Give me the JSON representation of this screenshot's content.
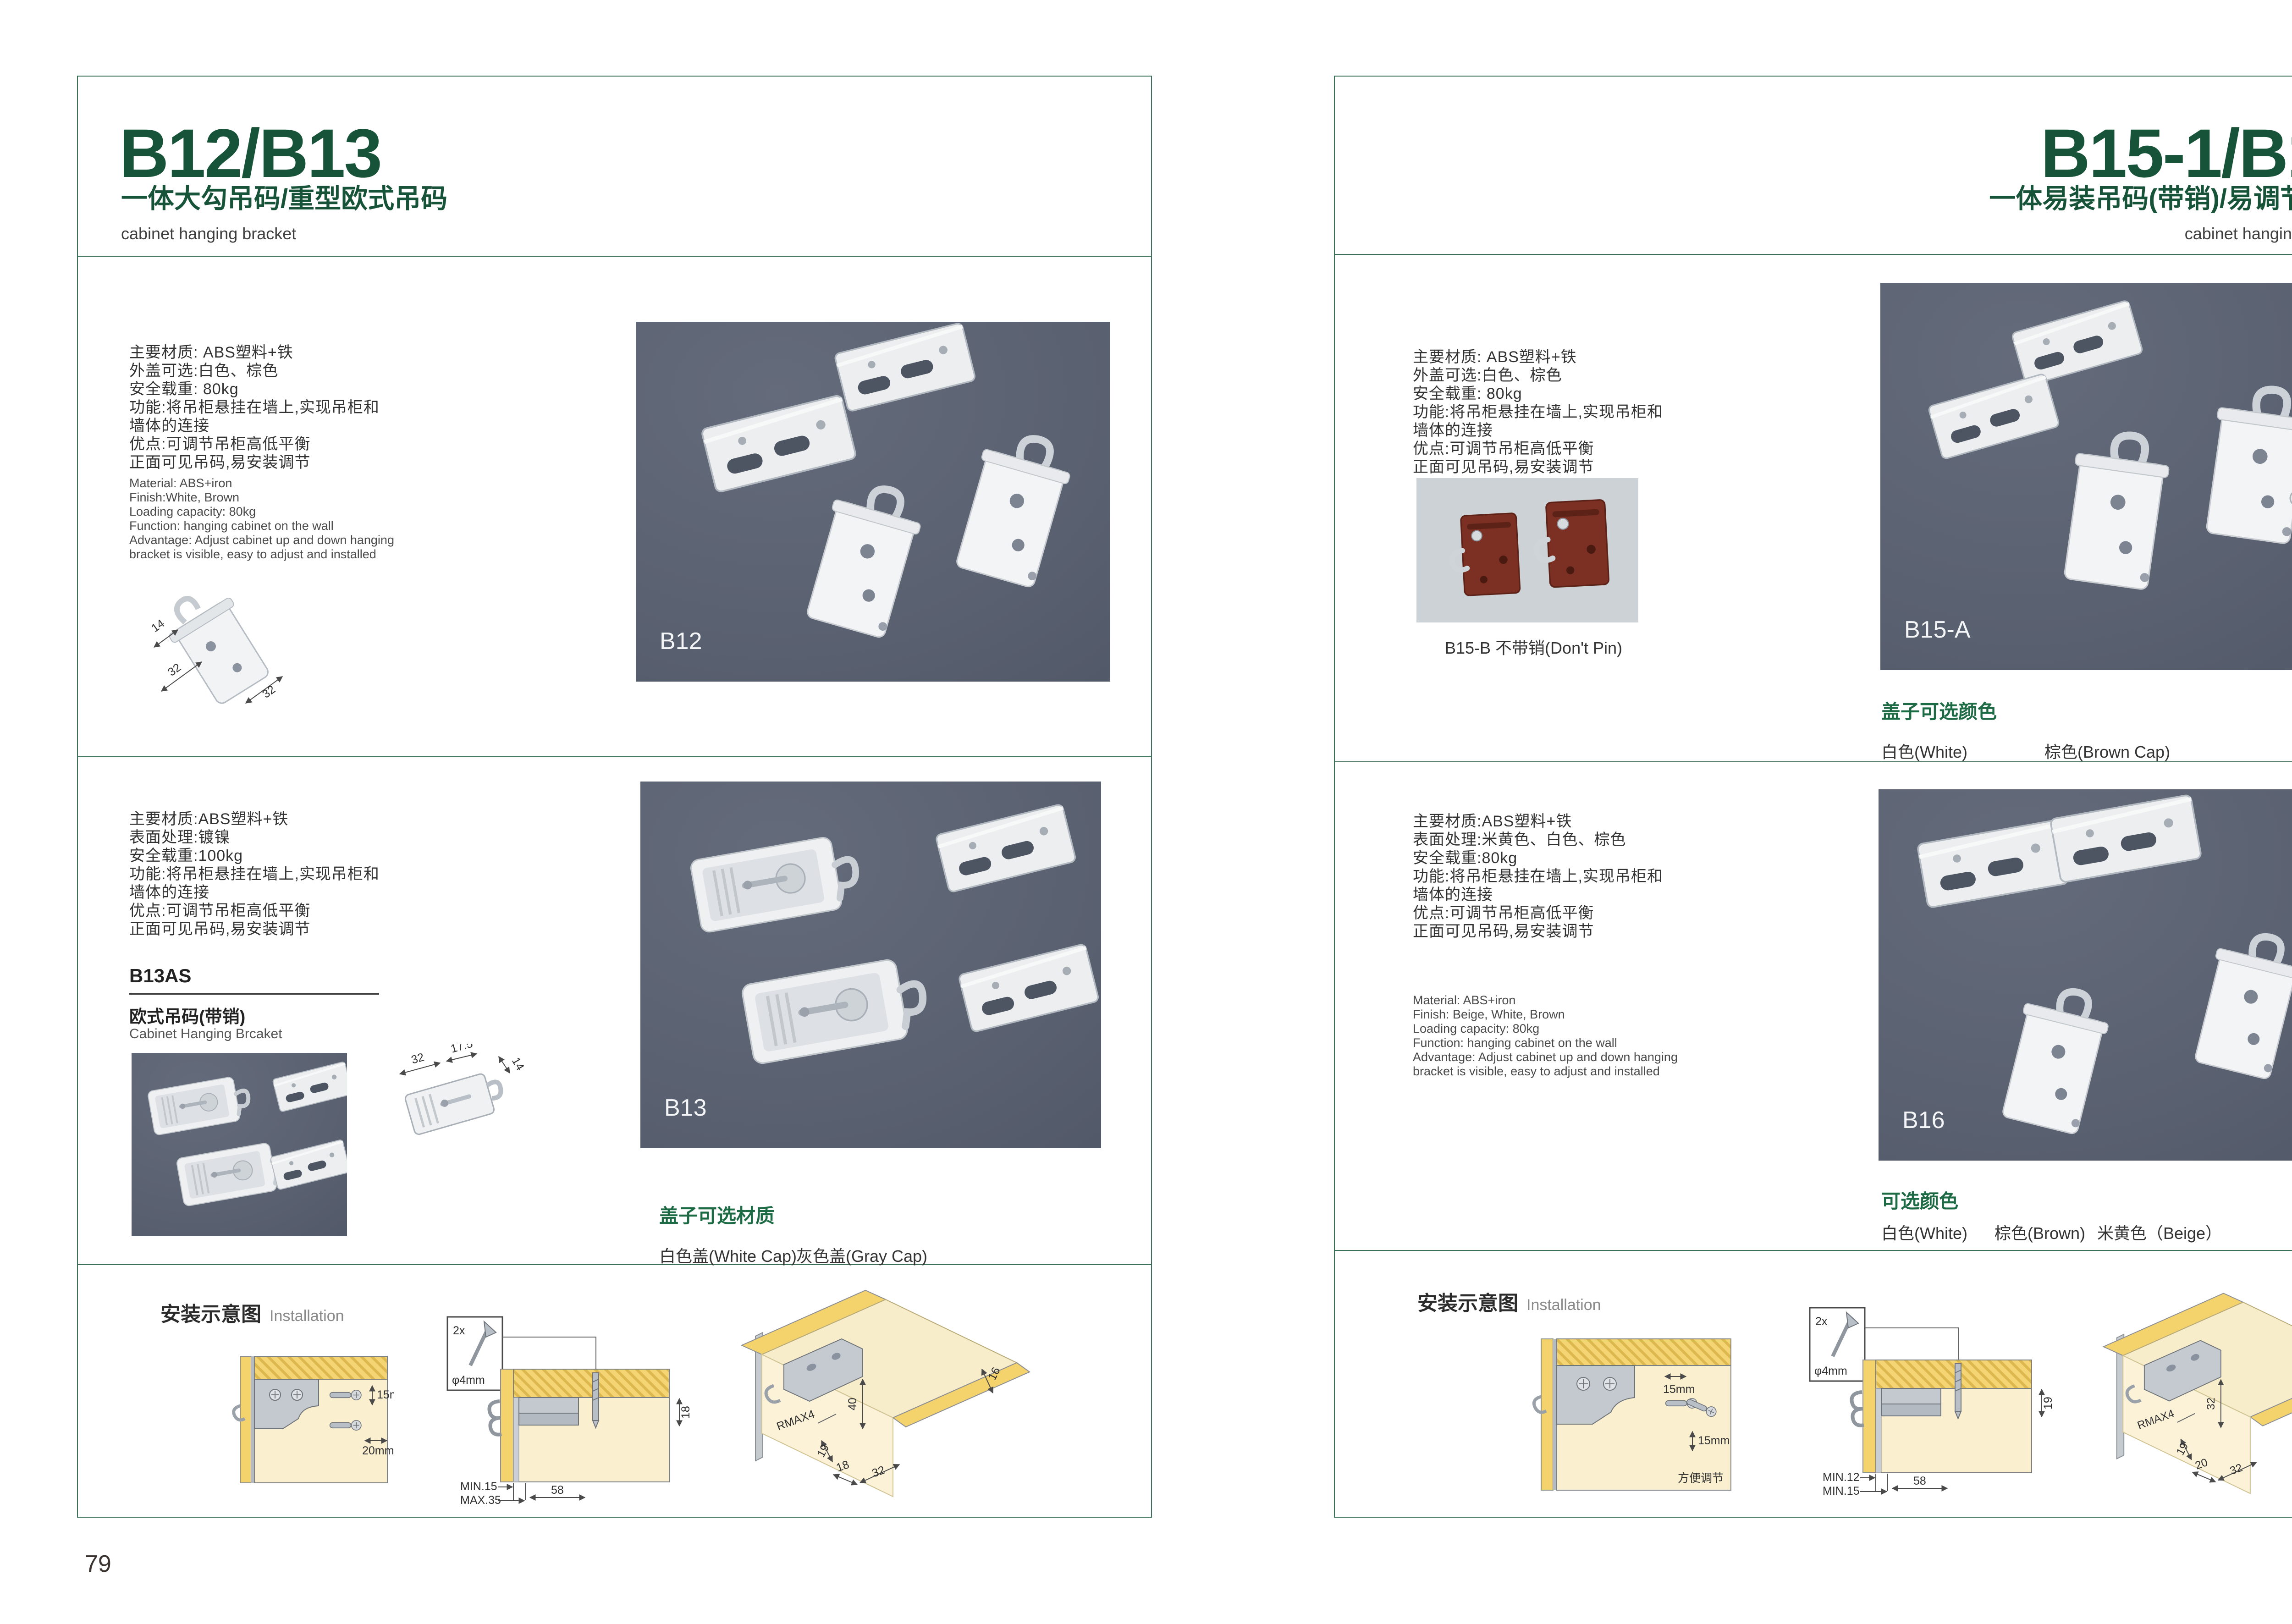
{
  "colors": {
    "accent_green": "#175339",
    "frame_green": "#3a6f58",
    "photo_dark_bg": "#596070",
    "photo_light_bg": "#cdd2d6",
    "wood_yellow": "#f4d36c",
    "wood_face": "#faf0d0"
  },
  "left": {
    "title": "B12/B13",
    "subtitle": "一体大勾吊码/重型欧式吊码",
    "category_en": "cabinet hanging bracket",
    "page_no": "79",
    "s1": {
      "cn": [
        "主要材质: ABS塑料+铁",
        "外盖可选:白色、棕色",
        "安全载重: 80kg",
        "功能:将吊柜悬挂在墙上,实现吊柜和",
        "墙体的连接",
        "优点:可调节吊柜高低平衡",
        "正面可见吊码,易安装调节"
      ],
      "en": [
        "Material: ABS+iron",
        "Finish:White, Brown",
        "Loading capacity: 80kg",
        "Function: hanging cabinet on the wall",
        "Advantage: Adjust cabinet up and down hanging",
        "bracket is visible, easy to adjust and installed"
      ],
      "sketch_dims": {
        "d1": "14",
        "d2": "32",
        "d3": "32"
      },
      "photo_label": "B12"
    },
    "s2": {
      "cn": [
        "主要材质:ABS塑料+铁",
        "表面处理:镀镍",
        "安全载重:100kg",
        "功能:将吊柜悬挂在墙上,实现吊柜和",
        "墙体的连接",
        "优点:可调节吊柜高低平衡",
        "正面可见吊码,易安装调节"
      ],
      "model": "B13AS",
      "model_cn": "欧式吊码(带销)",
      "model_en": "Cabinet Hanging Brcaket",
      "tech_dims": {
        "d1": "32",
        "d2": "17.5",
        "d3": "14"
      },
      "photo_label": "B13",
      "cap_title": "盖子可选材质",
      "cap_opt1": "白色盖(White Cap)",
      "cap_opt2": "灰色盖(Gray Cap)"
    },
    "inst": {
      "title_cn": "安装示意图",
      "title_en": "Installation",
      "a_dim1": "15mm",
      "a_dim2": "20mm",
      "b_qty": "2x",
      "b_dia": "φ4mm",
      "b_h": "18",
      "b_l1": "MIN.15",
      "b_l2": "MAX.35",
      "b_w": "58",
      "c_d1": "16",
      "c_d2": "40",
      "c_d3": "RMAX4",
      "c_d4": "19",
      "c_d5": "18",
      "c_d6": "32"
    }
  },
  "right": {
    "title": "B15-1/B16",
    "subtitle": "一体易装吊码(带销)/易调节吊码",
    "category_en": "cabinet hanging bracket",
    "page_no": "80",
    "s1": {
      "cn": [
        "主要材质: ABS塑料+铁",
        "外盖可选:白色、棕色",
        "安全载重: 80kg",
        "功能:将吊柜悬挂在墙上,实现吊柜和",
        "墙体的连接",
        "优点:可调节吊柜高低平衡",
        "正面可见吊码,易安装调节"
      ],
      "photo_small_caption": "B15-B 不带销(Don't Pin)",
      "photo_label": "B15-A",
      "cap_title": "盖子可选颜色",
      "cap_opt1": "白色(White)",
      "cap_opt2": "棕色(Brown Cap)"
    },
    "s2": {
      "cn": [
        "主要材质:ABS塑料+铁",
        "表面处理:米黄色、白色、棕色",
        "安全载重:80kg",
        "功能:将吊柜悬挂在墙上,实现吊柜和",
        "墙体的连接",
        "优点:可调节吊柜高低平衡",
        "正面可见吊码,易安装调节"
      ],
      "en": [
        "Material: ABS+iron",
        "Finish: Beige, White, Brown",
        "Loading capacity: 80kg",
        "Function: hanging cabinet on the wall",
        "Advantage: Adjust cabinet up and down hanging",
        "bracket is visible, easy to adjust and installed"
      ],
      "photo_label": "B16",
      "color_title": "可选颜色",
      "opt1": "白色(White)",
      "opt2": "棕色(Brown)",
      "opt3": "米黄色（Beige）"
    },
    "inst": {
      "title_cn": "安装示意图",
      "title_en": "Installation",
      "a_dim1": "15mm",
      "a_dim2": "15mm",
      "a_note": "方便调节",
      "b_qty": "2x",
      "b_dia": "φ4mm",
      "b_h": "19",
      "b_l1": "MIN.12",
      "b_l2": "MIN.15",
      "b_w": "58",
      "c_d1": "30",
      "c_d2": "32",
      "c_d3": "RMAX4",
      "c_d4": "19",
      "c_d5": "20",
      "c_d6": "32"
    }
  }
}
